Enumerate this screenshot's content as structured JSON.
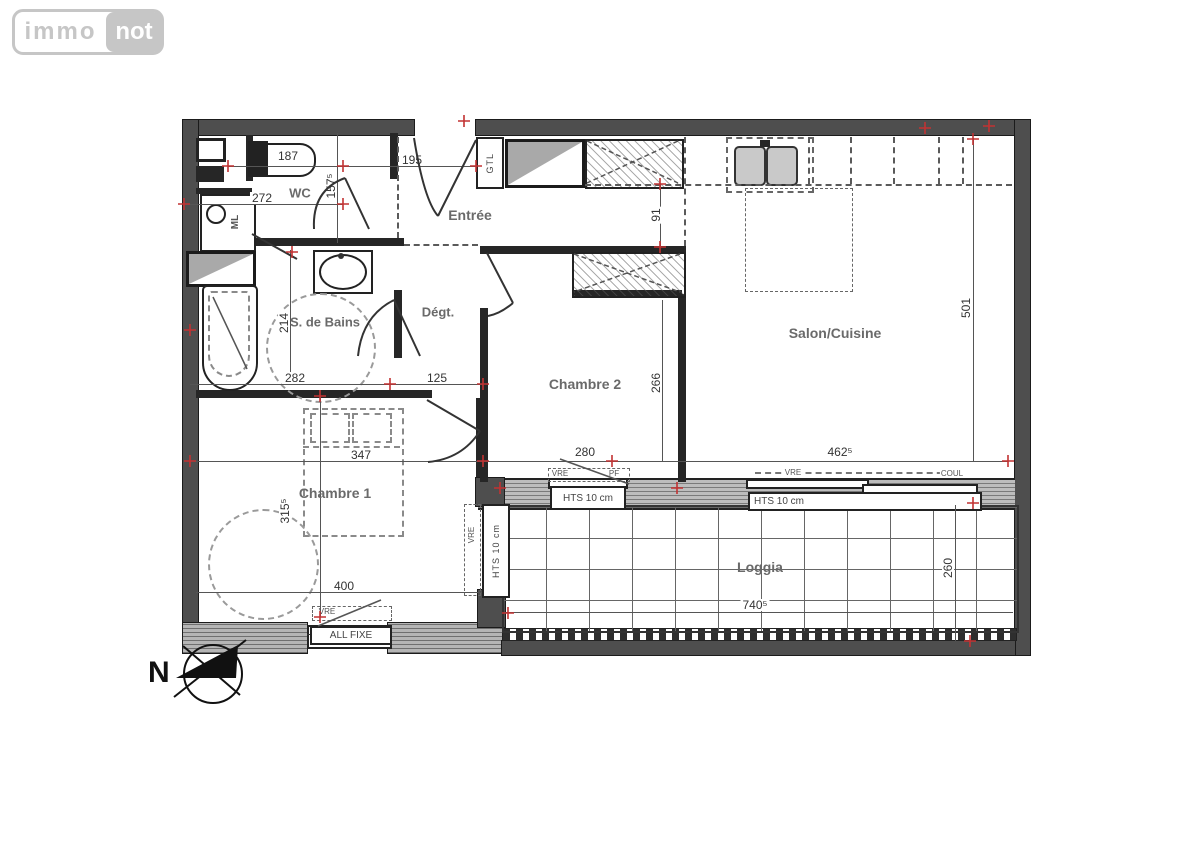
{
  "logo": {
    "immo": "immo",
    "not": "not"
  },
  "compass": {
    "north": "N"
  },
  "rooms": {
    "wc": "WC",
    "entree": "Entrée",
    "bains": "S. de Bains",
    "degagement": "Dégt.",
    "chambre2": "Chambre 2",
    "salon": "Salon/Cuisine",
    "chambre1": "Chambre 1",
    "loggia": "Loggia"
  },
  "fixtures": {
    "ml": "ML",
    "gtl": "GTL"
  },
  "openings": {
    "hts": "HTS 10 cm",
    "all_fixe": "ALL FIXE",
    "vre": "VRE",
    "pf": "PF",
    "coul": "COUL"
  },
  "dims": {
    "d187": "187",
    "d195": "195",
    "d157": "157⁵",
    "d272": "272",
    "d91": "91",
    "d501": "501",
    "d214": "214",
    "d282": "282",
    "d125": "125",
    "d266": "266",
    "d280": "280",
    "d347": "347",
    "d462": "462⁵",
    "d400": "400",
    "d315": "315⁵",
    "d740": "740⁵",
    "d260": "260"
  },
  "colors": {
    "wall": "#4e4e4e",
    "marker": "#c23232",
    "label": "#6a6a6a",
    "logo_gray": "#c6c6c6"
  }
}
